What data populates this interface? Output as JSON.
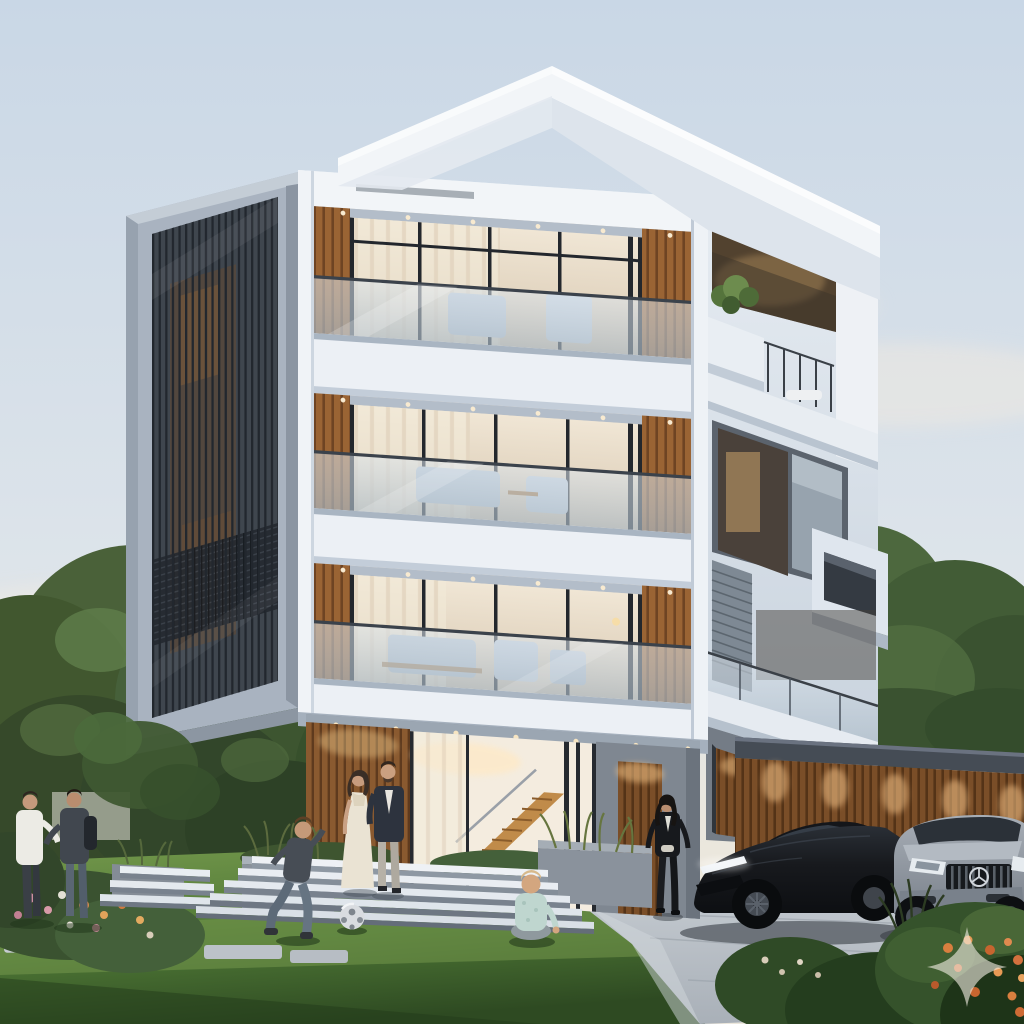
{
  "image": {
    "kind": "photorealistic-architectural-render",
    "width": 1024,
    "height": 1024
  },
  "scene": {
    "setting": "modern four-storey residence at dusk with front lawn, driveway and parked cars",
    "labels": {
      "sky": "pale dusk sky with soft clouds",
      "trees_left": "tall green trees left of the house",
      "trees_right": "trees and hedge behind the garage",
      "neighbor_house": "neighbouring white house with grey gable roof",
      "building": "modern white house with stacked volumes, wood slats and glass balconies",
      "left_screen": "dark vertical louvered screen facade in grey frame",
      "front_facade": "white front facade with three recessed glass balconies",
      "right_section": "stepped right volumes with roof terrace and cantilevered box",
      "ground_floor": "glass entrance with interior wooden staircase and wood-slat walls",
      "roof": "white cantilevered flat roof slab",
      "steps": "floating white entrance steps",
      "planters": "grey planter boxes with ornamental grasses",
      "lawn": "front lawn with light and shadow bands",
      "stepping_stones": "stepping stone path across the lawn",
      "flower_bed": "flower bed with pink and orange blooms",
      "driveway": "light grey paved driveway",
      "garage": "garage wall clad in warm wood slats with downlights",
      "men_talking": "two men talking on the lawn",
      "couple": "couple standing at the entrance steps",
      "boy": "boy running toward a soccer ball",
      "ball": "soccer ball on the lawn",
      "toddler": "toddler sitting on the lawn",
      "woman_walking": "woman in black walking on the driveway",
      "black_car": "black sports sedan",
      "silver_car": "silver luxury SUV with chrome grille",
      "bushes_front": "foreground shrubs with orange flowers",
      "watermark": "translucent four-point sparkle watermark"
    }
  },
  "palette": {
    "sky_top": "#c9d7e6",
    "sky_mid": "#dde4ea",
    "sky_horizon": "#ece7dc",
    "facade_white": "#e9eef3",
    "facade_bright": "#f2f5f8",
    "facade_shadow": "#b9c4d0",
    "frame_grey": "#a9b3c0",
    "screen_dark": "#3f464e",
    "louver_line": "#22272e",
    "wood": "#9a6434",
    "wood_dark": "#6e4423",
    "garage_wood": "#7a4e28",
    "glass_warm_hi": "#f0e6d5",
    "glass_warm_lo": "#d8c8b1",
    "glass_cool": "#cfdae4",
    "mullion": "#23272d",
    "grass_light": "#6f9449",
    "grass_dark": "#2e4a22",
    "driveway_hi": "#c4cad0",
    "driveway_lo": "#a9b0b8",
    "planter_grey": "#8a929c",
    "step_white": "#e8edf2",
    "tree_green": "#49613b",
    "tree_highlight": "#5f7e4b",
    "tree_dark": "#33462a",
    "neighbor_roof": "#6f7885",
    "neighbor_wall": "#e6e8e9",
    "car_black": "#17191d",
    "car_silver": "#a7aeb6",
    "flower_orange": "#dd8a4f",
    "flower_pink": "#cf8fa0",
    "watermark": "#f1ebe0"
  }
}
